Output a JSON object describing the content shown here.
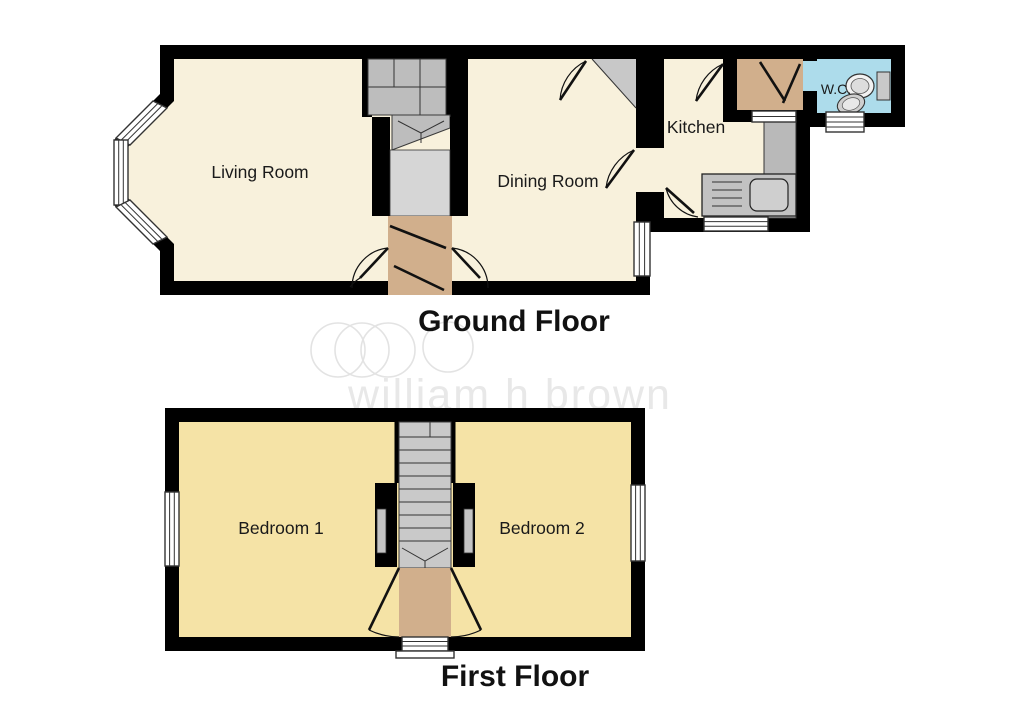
{
  "ground_floor": {
    "title": "Ground Floor",
    "rooms": [
      {
        "label": "Living Room"
      },
      {
        "label": "Dining Room"
      },
      {
        "label": "Kitchen"
      },
      {
        "label": "W.C."
      }
    ]
  },
  "first_floor": {
    "title": "First Floor",
    "rooms": [
      {
        "label": "Bedroom 1"
      },
      {
        "label": "Bedroom 2"
      }
    ]
  },
  "watermark": {
    "text": "william h brown",
    "logo": "overlapping-circles-icon"
  },
  "colors": {
    "wall": "#000000",
    "ground_floor_fill": "#F8F1DC",
    "first_floor_fill": "#F5E3A6",
    "wc_fill": "#ADDCEB",
    "door_area_fill": "#D1AF8C",
    "hall_fill": "#D6D6D6",
    "stairs_fill": "#C4C4C4",
    "counter_fill": "#B9B9B9",
    "watermark": "#E8E8E8"
  }
}
